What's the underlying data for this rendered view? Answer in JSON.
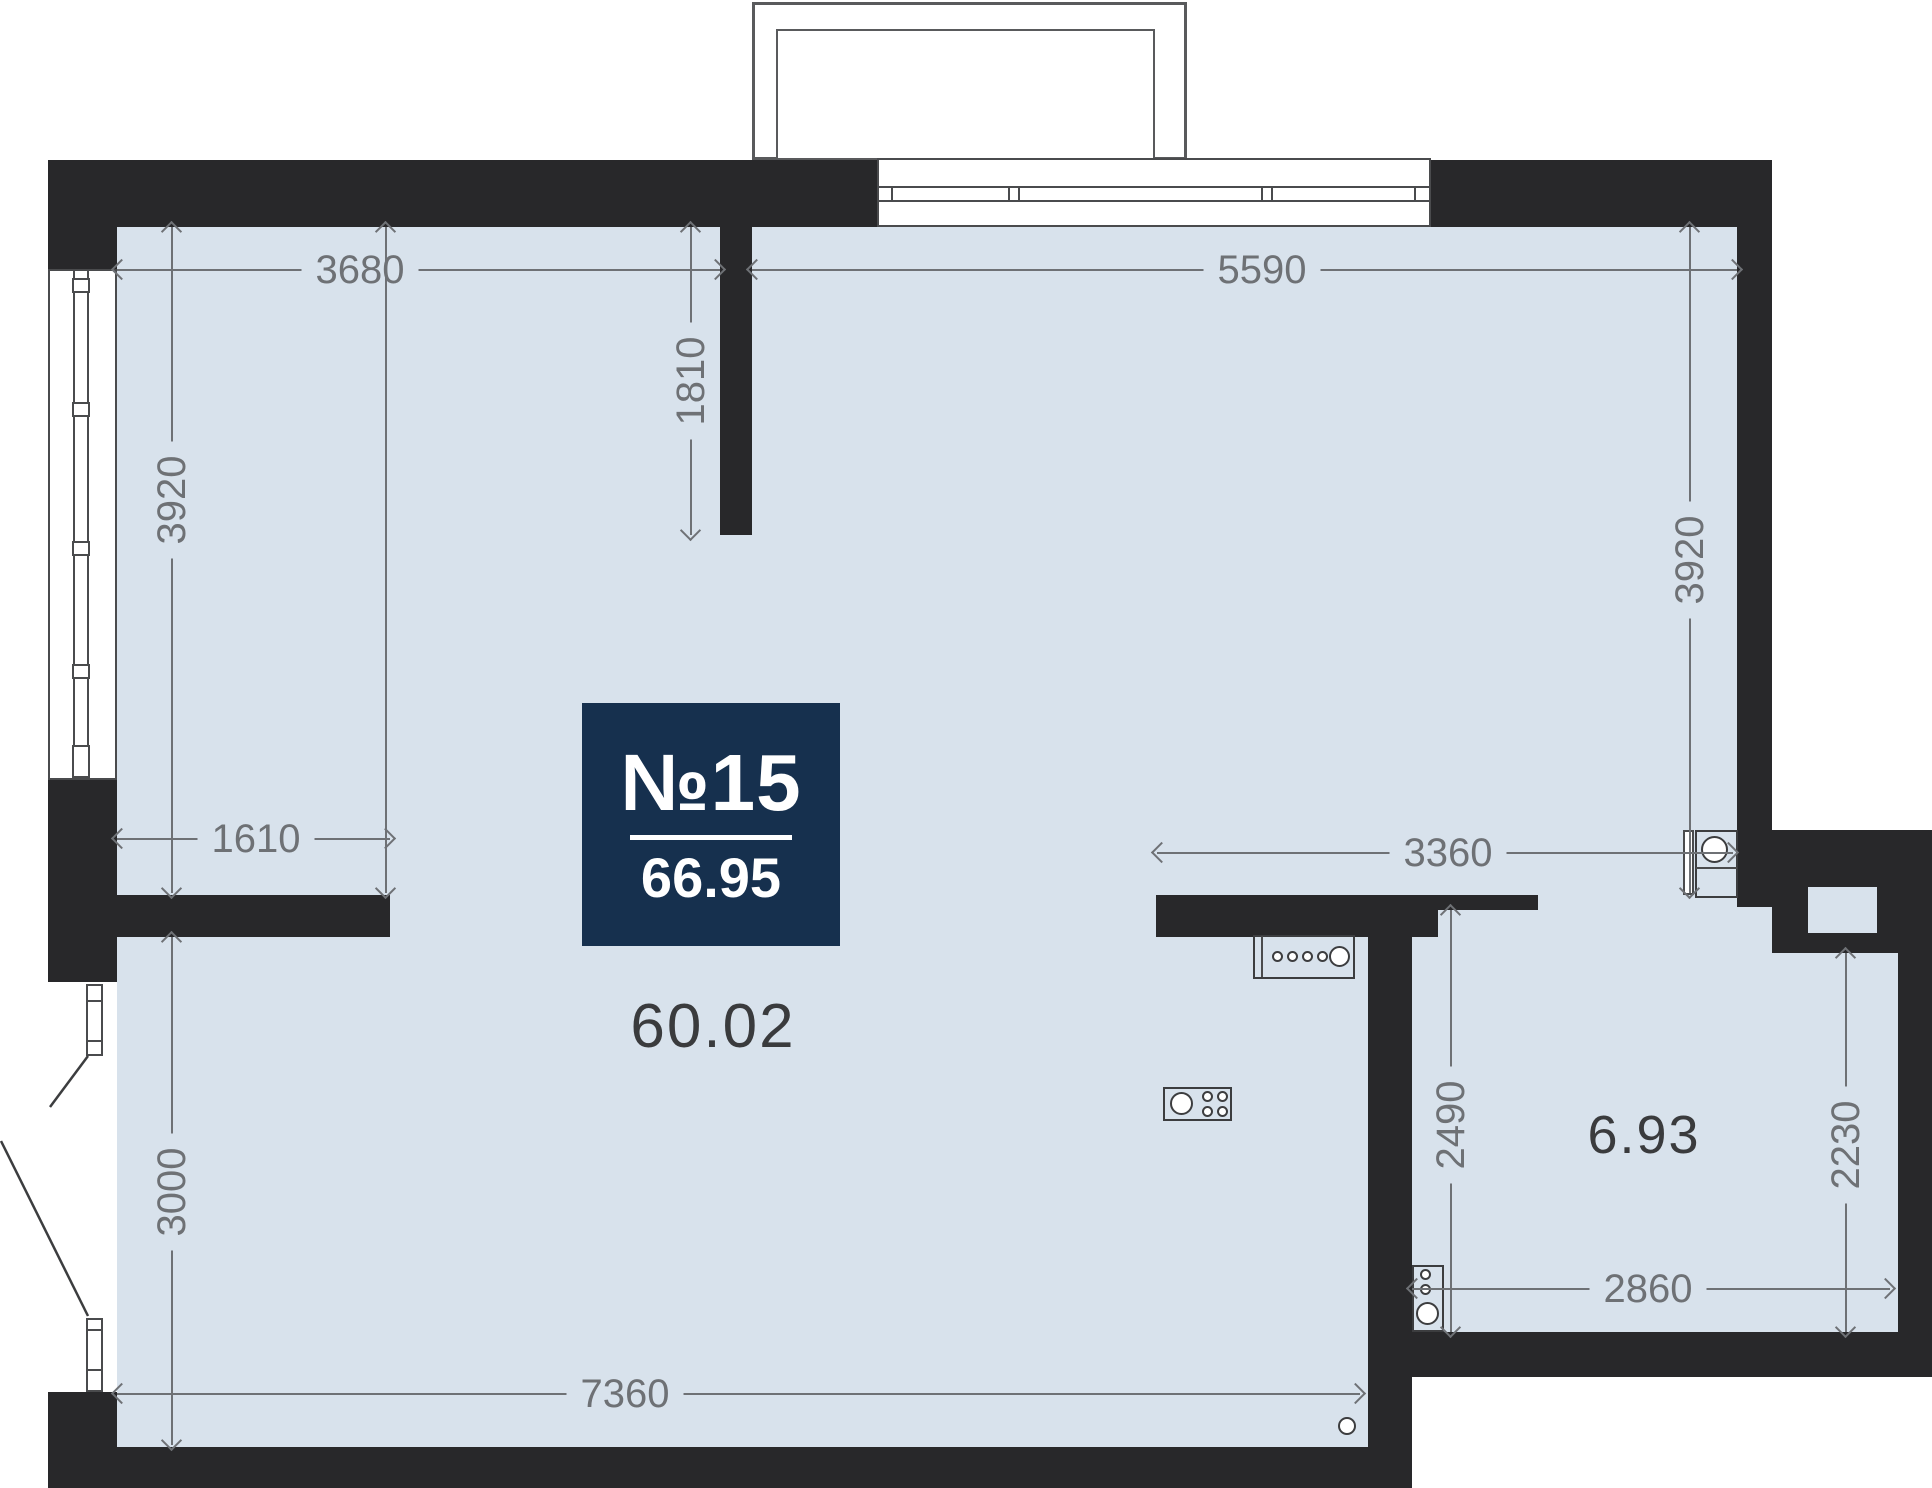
{
  "plan": {
    "badge": {
      "unit_number": "№15",
      "total_area": "66.95"
    },
    "rooms": {
      "main_area": "60.02",
      "bathroom_area": "6.93"
    },
    "dimensions": {
      "top_left_width": "3680",
      "top_right_width": "5590",
      "entry_stub_depth": "1810",
      "left_height": "3920",
      "right_height": "3920",
      "left_inner_width": "1610",
      "kitchen_width": "3360",
      "bathroom_left_height": "2490",
      "bathroom_right_height": "2230",
      "bathroom_width": "2860",
      "lower_left_height": "3000",
      "bottom_width": "7360"
    },
    "colors": {
      "wall": "#28282a",
      "floor": "#d8e2ec",
      "badge_background": "#16304e",
      "dimension_gray": "#6e7175",
      "area_text": "#3a3b3d"
    }
  }
}
